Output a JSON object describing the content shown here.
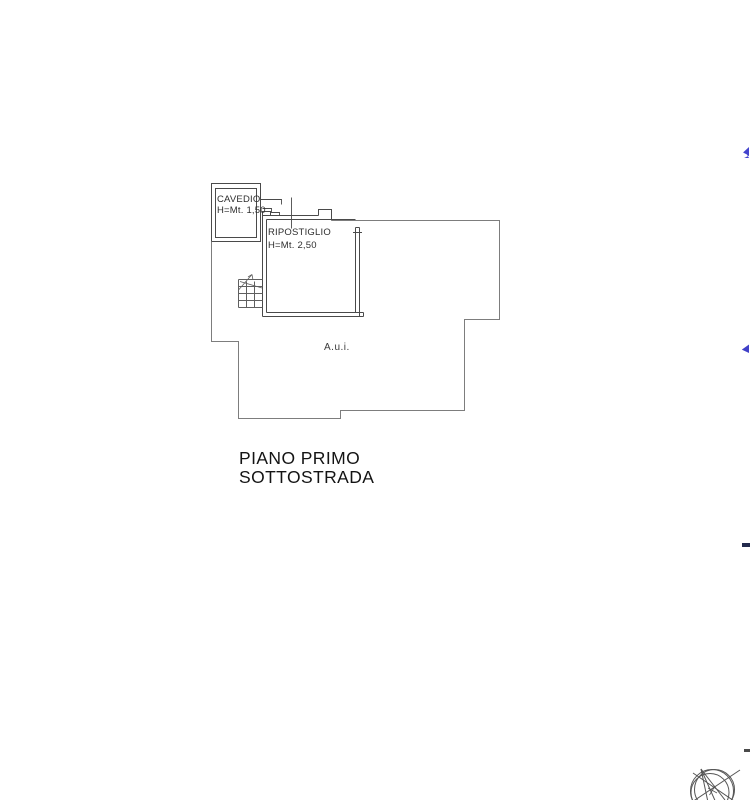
{
  "plan": {
    "cavedio": {
      "name": "CAVEDIO",
      "height": "H=Mt. 1,50"
    },
    "ripostiglio": {
      "name": "RIPOSTIGLIO",
      "height": "H=Mt. 2,50"
    },
    "area_label": "A.u.i.",
    "floor_title": {
      "line1": "PIANO PRIMO",
      "line2": "SOTTOSTRADA"
    }
  },
  "icons": {
    "compass_rose": "compass-rose-icon",
    "stairs": "stairs-icon"
  },
  "colors": {
    "wall_line": "#4a4a4a",
    "boundary_line": "#7d7d7d",
    "stairs_line": "#5f5f5f",
    "compass_line": "#555555",
    "label_text": "#2e2e2e",
    "title_text": "#141414",
    "edge_mark_blue": "#4343cd",
    "edge_mark_navy": "#232a4d"
  }
}
